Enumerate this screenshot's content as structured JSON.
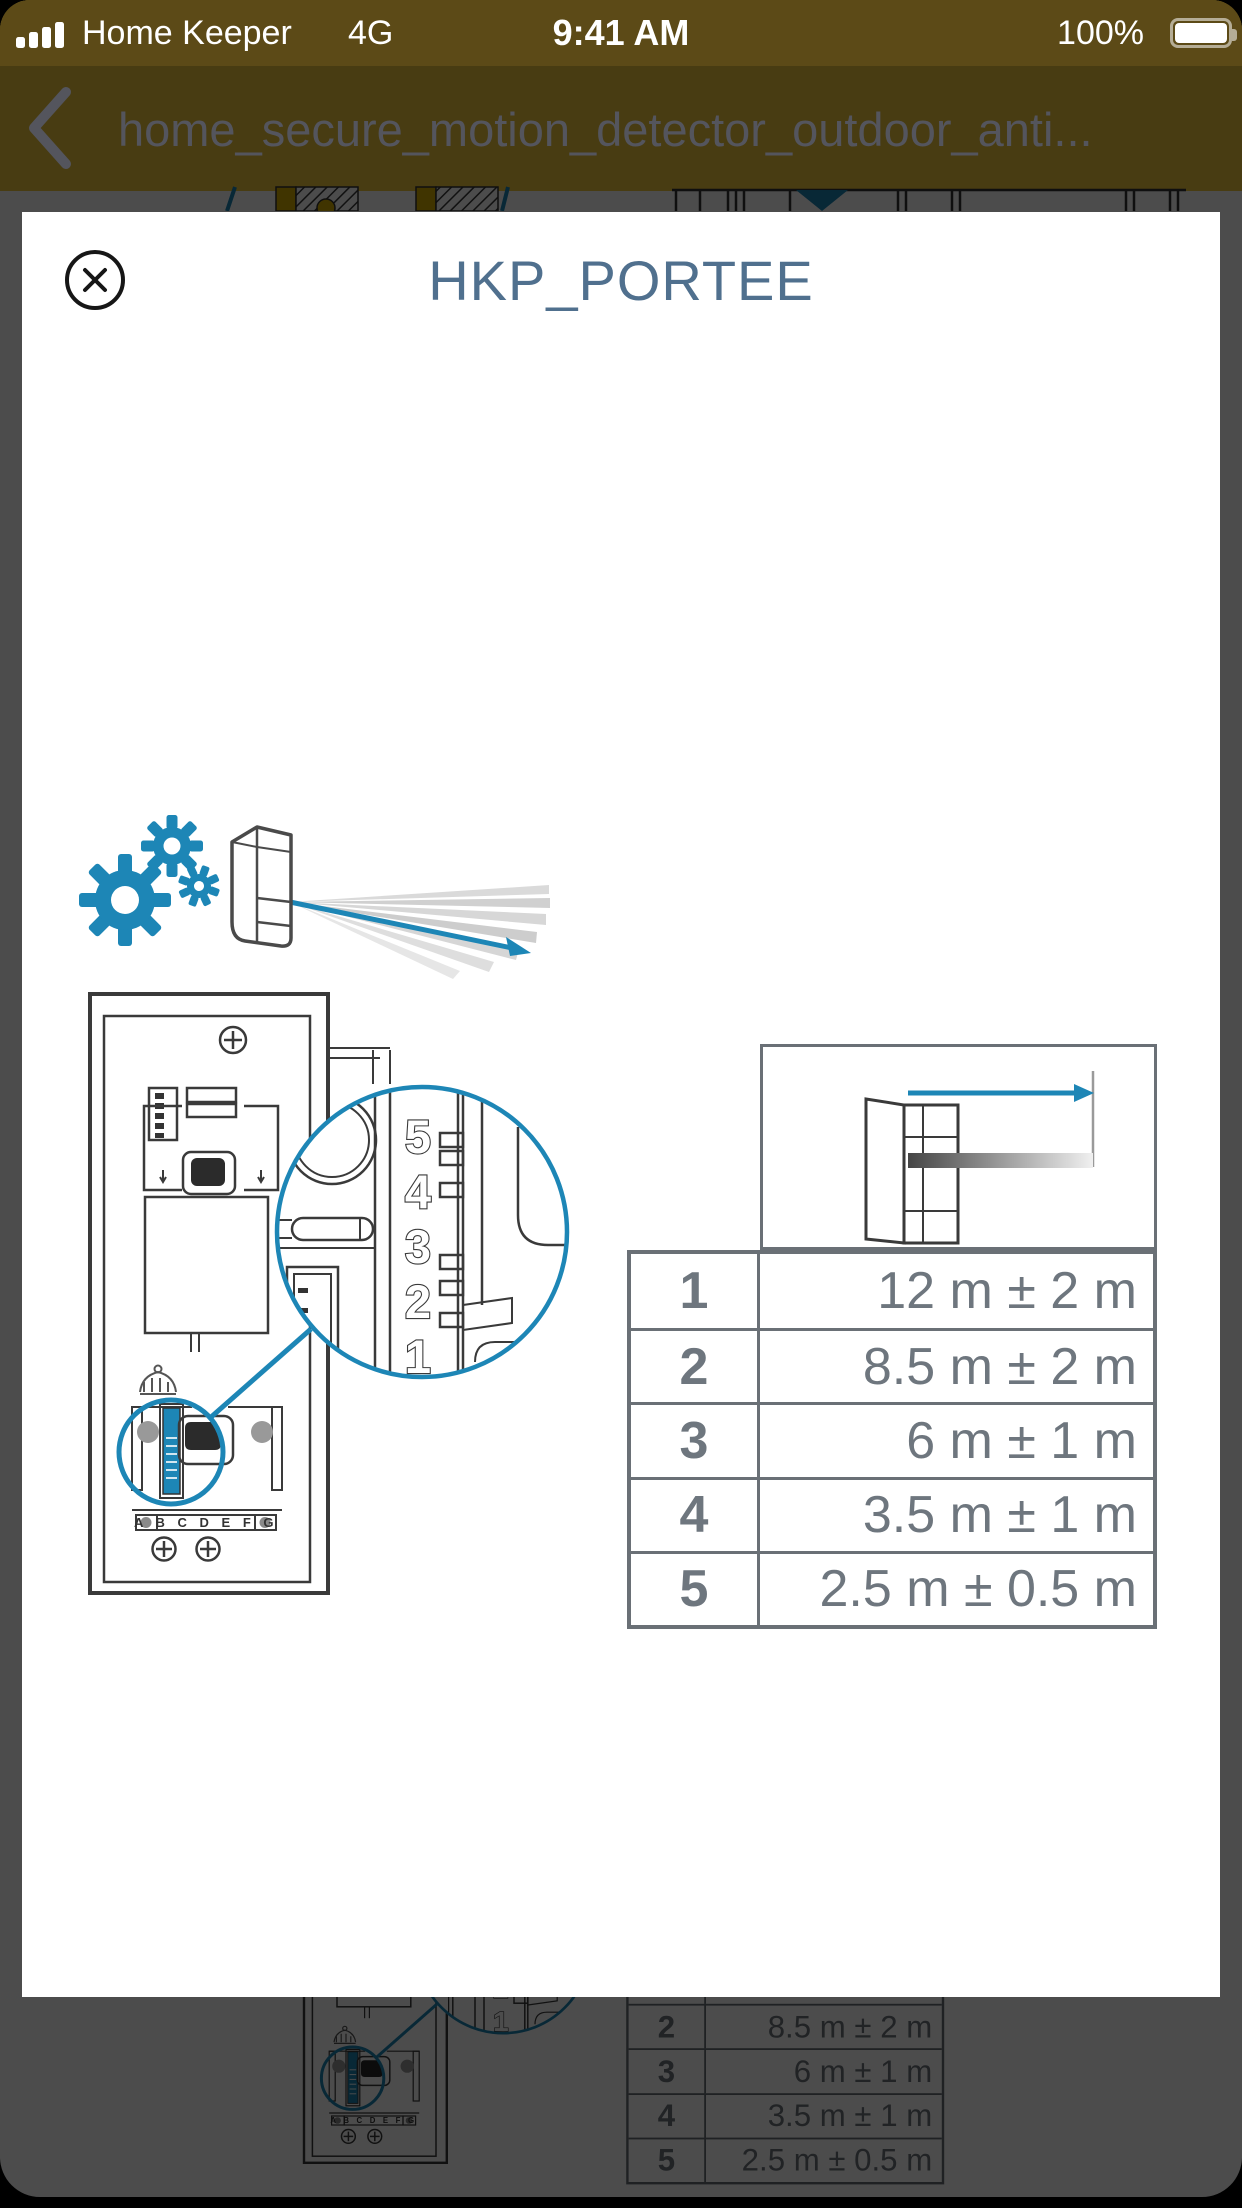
{
  "colors": {
    "accent_blue": "#1d86b6",
    "brand_yellow": "#f2c83c",
    "modal_title": "#50708e",
    "nav_text": "#54555d",
    "table_border": "#6a7076",
    "table_text": "#6e767e",
    "dim_overlay": "rgba(0,0,0,0.70)"
  },
  "status_bar": {
    "signal_icon": "signal-bars-4",
    "carrier": "Home Keeper",
    "network": "4G",
    "time": "9:41 AM",
    "battery_percent": "100%",
    "battery_icon": "battery-full"
  },
  "nav": {
    "back_icon": "chevron-left",
    "title": "home_secure_motion_detector_outdoor_anti..."
  },
  "modal": {
    "close_icon": "close-circle-x",
    "title": "HKP_PORTEE"
  },
  "figure": {
    "gears_icon": "settings-gears",
    "detector_icon": "motion-detector-with-beams",
    "magnifier_dial_numbers": [
      "5",
      "4",
      "3",
      "2",
      "1"
    ],
    "terminal_labels": "A B C D E F G",
    "range_table": {
      "rows": [
        {
          "pos": "1",
          "range": "12 m ± 2 m"
        },
        {
          "pos": "2",
          "range": "8.5 m ± 2 m"
        },
        {
          "pos": "3",
          "range": "6 m ± 1 m"
        },
        {
          "pos": "4",
          "range": "3.5 m ± 1 m"
        },
        {
          "pos": "5",
          "range": "2.5 m ± 0.5 m"
        }
      ]
    }
  }
}
